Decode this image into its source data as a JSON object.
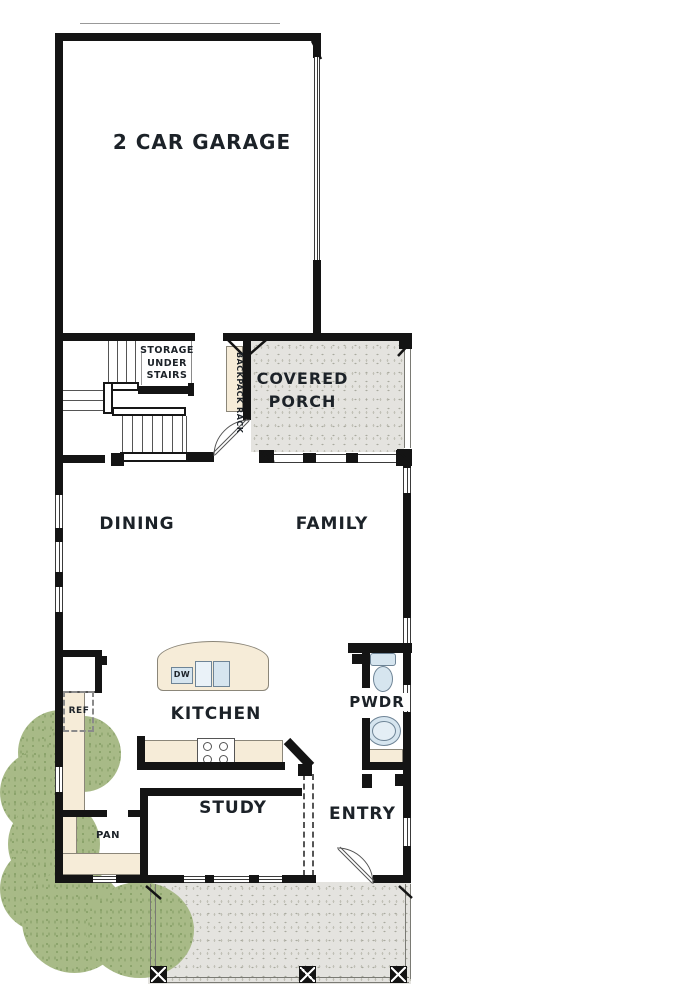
{
  "plan": {
    "title": "First floor plan",
    "labels": {
      "garage": "2 CAR GARAGE",
      "storage": "STORAGE UNDER STAIRS",
      "backpack_rack": "BACKPACK RACK",
      "covered_porch": "COVERED PORCH",
      "dining": "DINING",
      "family": "FAMILY",
      "kitchen": "KITCHEN",
      "powder": "PWDR",
      "refrigerator": "REF",
      "dishwasher": "DW",
      "pantry": "PAN",
      "study": "STUDY",
      "entry": "ENTRY"
    },
    "colors": {
      "wall": "#141414",
      "porch_floor": "#e4e3df",
      "counter": "#f6ecd8",
      "fixture": "#d6e5ef",
      "landscape": "#a8ba87",
      "background": "#ffffff"
    }
  }
}
